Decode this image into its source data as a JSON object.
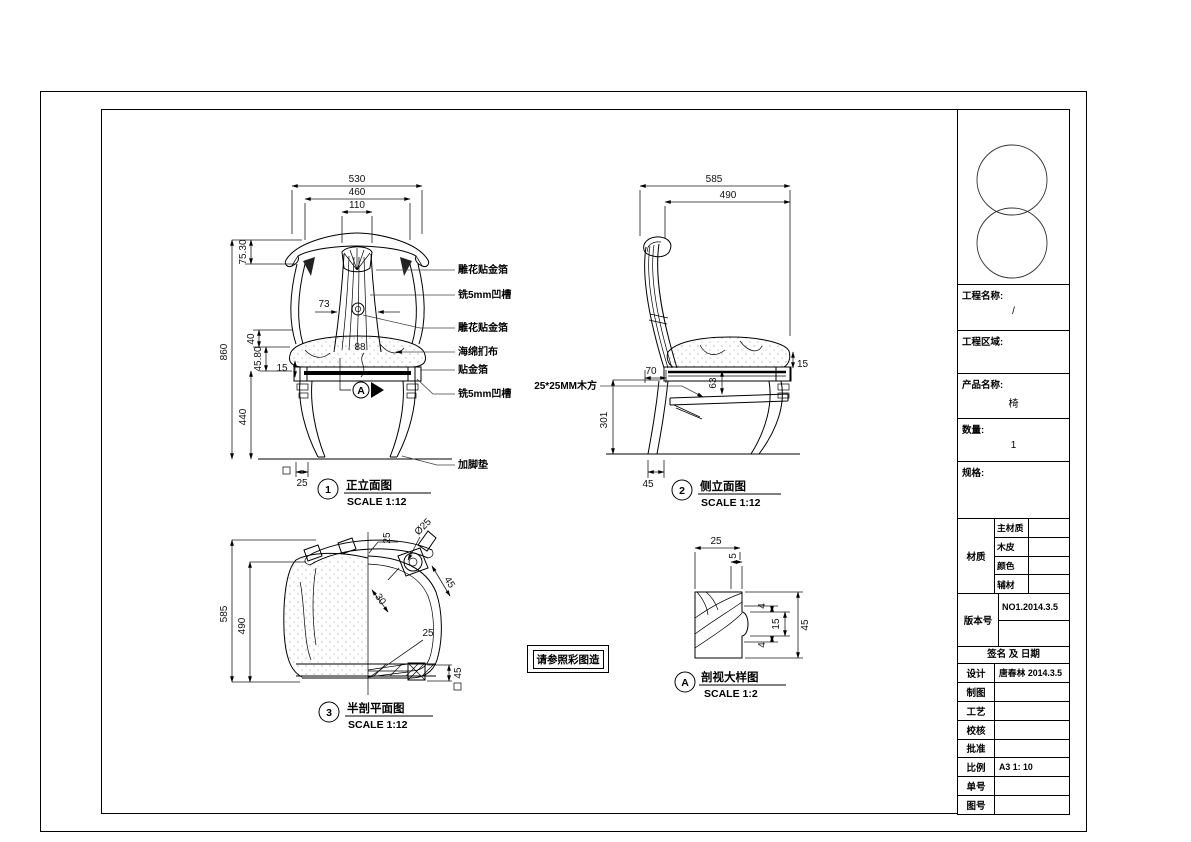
{
  "drawing": {
    "note": "请参照彩图造",
    "views": {
      "front": {
        "number": "1",
        "title": "正立面图",
        "scale": "SCALE 1:12",
        "dim_530": "530",
        "dim_460": "460",
        "dim_110": "110",
        "dim_7530": "75.30",
        "dim_860": "860",
        "dim_40": "40",
        "dim_4580": "45.80",
        "dim_440": "440",
        "dim_15": "15",
        "dim_73": "73",
        "dim_88": "88",
        "dim_25": "25",
        "marker": "A",
        "callouts": [
          "雕花贴金箔",
          "铣5mm凹槽",
          "雕花贴金箔",
          "海绵扪布",
          "贴金箔",
          "铣5mm凹槽",
          "加脚垫"
        ]
      },
      "side": {
        "number": "2",
        "title": "侧立面图",
        "scale": "SCALE 1:12",
        "dim_585": "585",
        "dim_490": "490",
        "dim_70": "70",
        "dim_15": "15",
        "dim_63": "63",
        "dim_301": "301",
        "dim_45": "45",
        "callout_wood": "25*25MM木方"
      },
      "plan": {
        "number": "3",
        "title": "半剖平面图",
        "scale": "SCALE 1:12",
        "dim_585": "585",
        "dim_490": "490",
        "dim_25_top": "25",
        "dim_dia25": "Ø25",
        "dim_45_leg": "45",
        "dim_30": "30",
        "dim_25_side": "25",
        "dim_45_foot": "45"
      },
      "detail": {
        "number": "A",
        "title": "剖视大样图",
        "scale": "SCALE 1:2",
        "dim_25": "25",
        "dim_5": "5",
        "dim_4a": "4",
        "dim_15": "15",
        "dim_4b": "4",
        "dim_45": "45"
      }
    }
  },
  "titleblock": {
    "project_name_label": "工程名称:",
    "project_name_value": "/",
    "project_area_label": "工程区域:",
    "product_name_label": "产品名称:",
    "product_name_value": "椅",
    "quantity_label": "数量:",
    "quantity_value": "1",
    "spec_label": "规格:",
    "material_label": "材质",
    "material_rows": [
      "主材质",
      "木皮",
      "颜色",
      "辅材"
    ],
    "version_label": "版本号",
    "version_value": "NO1.2014.3.5",
    "sign_header": "签名 及 日期",
    "rows": [
      {
        "label": "设计",
        "value": "唐春林 2014.3.5"
      },
      {
        "label": "制图",
        "value": ""
      },
      {
        "label": "工艺",
        "value": ""
      },
      {
        "label": "校核",
        "value": ""
      },
      {
        "label": "批准",
        "value": ""
      },
      {
        "label": "比例",
        "value": "A3 1: 10"
      },
      {
        "label": "单号",
        "value": ""
      },
      {
        "label": "图号",
        "value": ""
      }
    ]
  }
}
